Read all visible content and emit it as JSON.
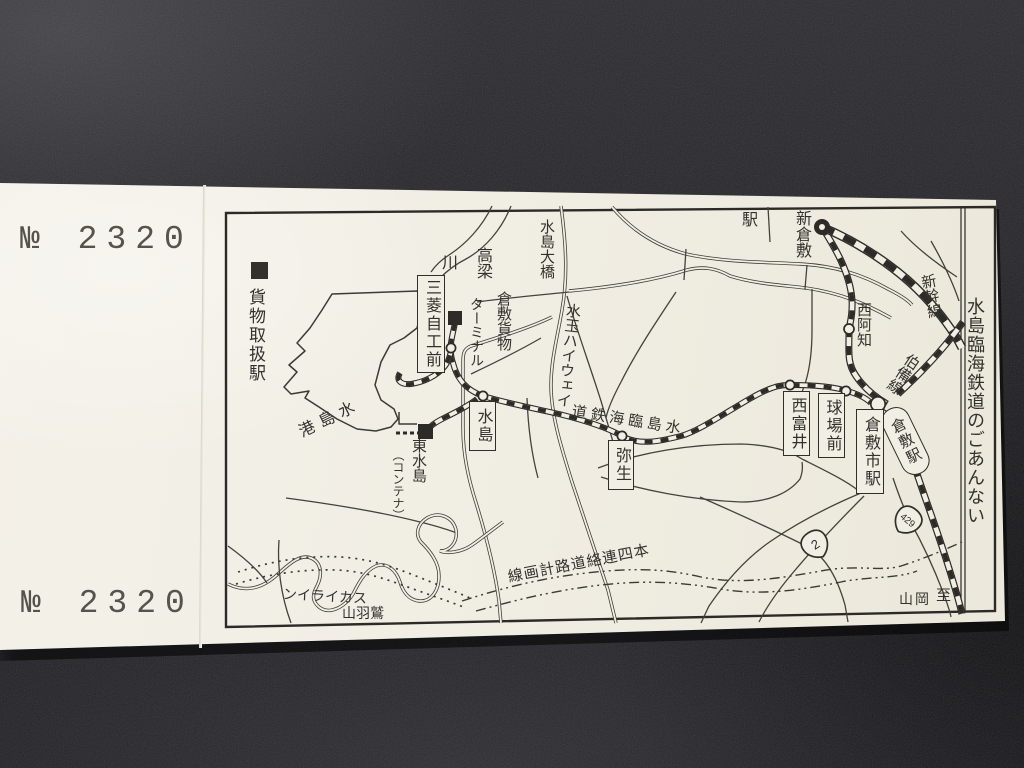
{
  "colors": {
    "paper": "#f1eee4",
    "ink": "#2f2e29",
    "background": "#26262b"
  },
  "ticket": {
    "serial": "№ 2320"
  },
  "legend": {
    "label": "貨物取扱駅"
  },
  "title": "水島臨海鉄道のごあんない",
  "map": {
    "stations": {
      "shin_kurashiki": {
        "name": "新倉敷",
        "suffix": "駅"
      },
      "nishi_achi": "西阿知",
      "kurashiki": "倉敷駅",
      "kurashiki_shi": "倉敷市駅",
      "kyujo_mae": "球場前",
      "nishi_tomii": "西富井",
      "yayoi": "弥生",
      "mizushima": "水島",
      "mitsubishi_jiko_mae": "三菱自工前",
      "higashi_mizushima": {
        "name": "東水島",
        "note": "（コンテナ）"
      }
    },
    "lines": {
      "rinkai": "水島臨海鉄道",
      "shinkansen": "新幹線",
      "hakubi": "伯備線"
    },
    "roads": {
      "route2": "2",
      "route429": "429",
      "honshi_planned": "本四連絡道路計画線",
      "mizutama_highway": "水玉ハイウェイ",
      "washuzan": "鷲羽山",
      "skyline": "スカイライン"
    },
    "places": {
      "takahashi_river": {
        "part1": "高梁",
        "part2": "川"
      },
      "mizushima_ohashi": "水島大橋",
      "freight_terminal": {
        "part1": "倉敷貨物",
        "part2": "ターミナル"
      },
      "mizushima_port": "水島港",
      "to_okayama": {
        "part1": "至",
        "part2": "岡山"
      }
    }
  }
}
